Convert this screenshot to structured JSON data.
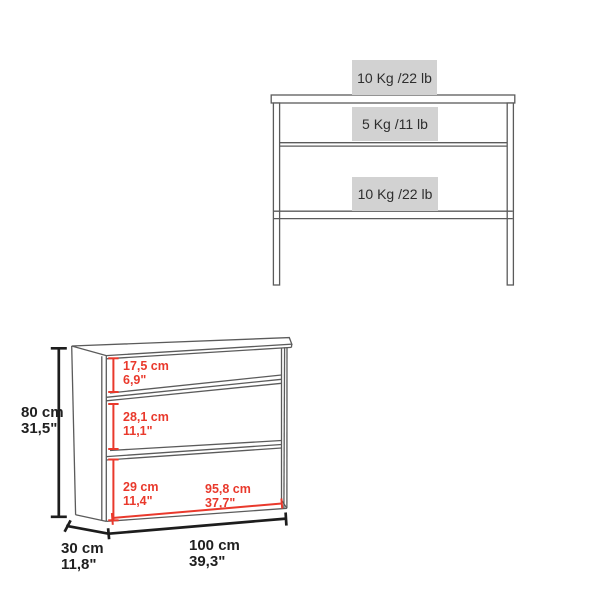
{
  "front_view": {
    "surface_loads": [
      {
        "position": "tabletop",
        "label": "10 Kg /22 lb"
      },
      {
        "position": "upper_shelf",
        "label": "5 Kg /11 lb"
      },
      {
        "position": "lower_shelf",
        "label": "10 Kg /22 lb"
      }
    ]
  },
  "iso_view": {
    "height": {
      "metric": "80 cm",
      "imperial": "31,5\""
    },
    "depth": {
      "metric": "30 cm",
      "imperial": "11,8\""
    },
    "width": {
      "metric": "100 cm",
      "imperial": "39,3\""
    },
    "top_opening": {
      "metric": "17,5 cm",
      "imperial": "6,9\""
    },
    "middle_opening": {
      "metric": "28,1 cm",
      "imperial": "11,1\""
    },
    "bottom_opening": {
      "metric": "29 cm",
      "imperial": "11,4\""
    },
    "inner_width": {
      "metric": "95,8 cm",
      "imperial": "37,7\""
    }
  },
  "colors": {
    "badge_background": "#d2d2d2",
    "badge_text": "#2e2e2e",
    "drawing_line": "#5b5b5b",
    "dimension_line": "#1d1d1d",
    "accent_red": "#e9392c"
  }
}
